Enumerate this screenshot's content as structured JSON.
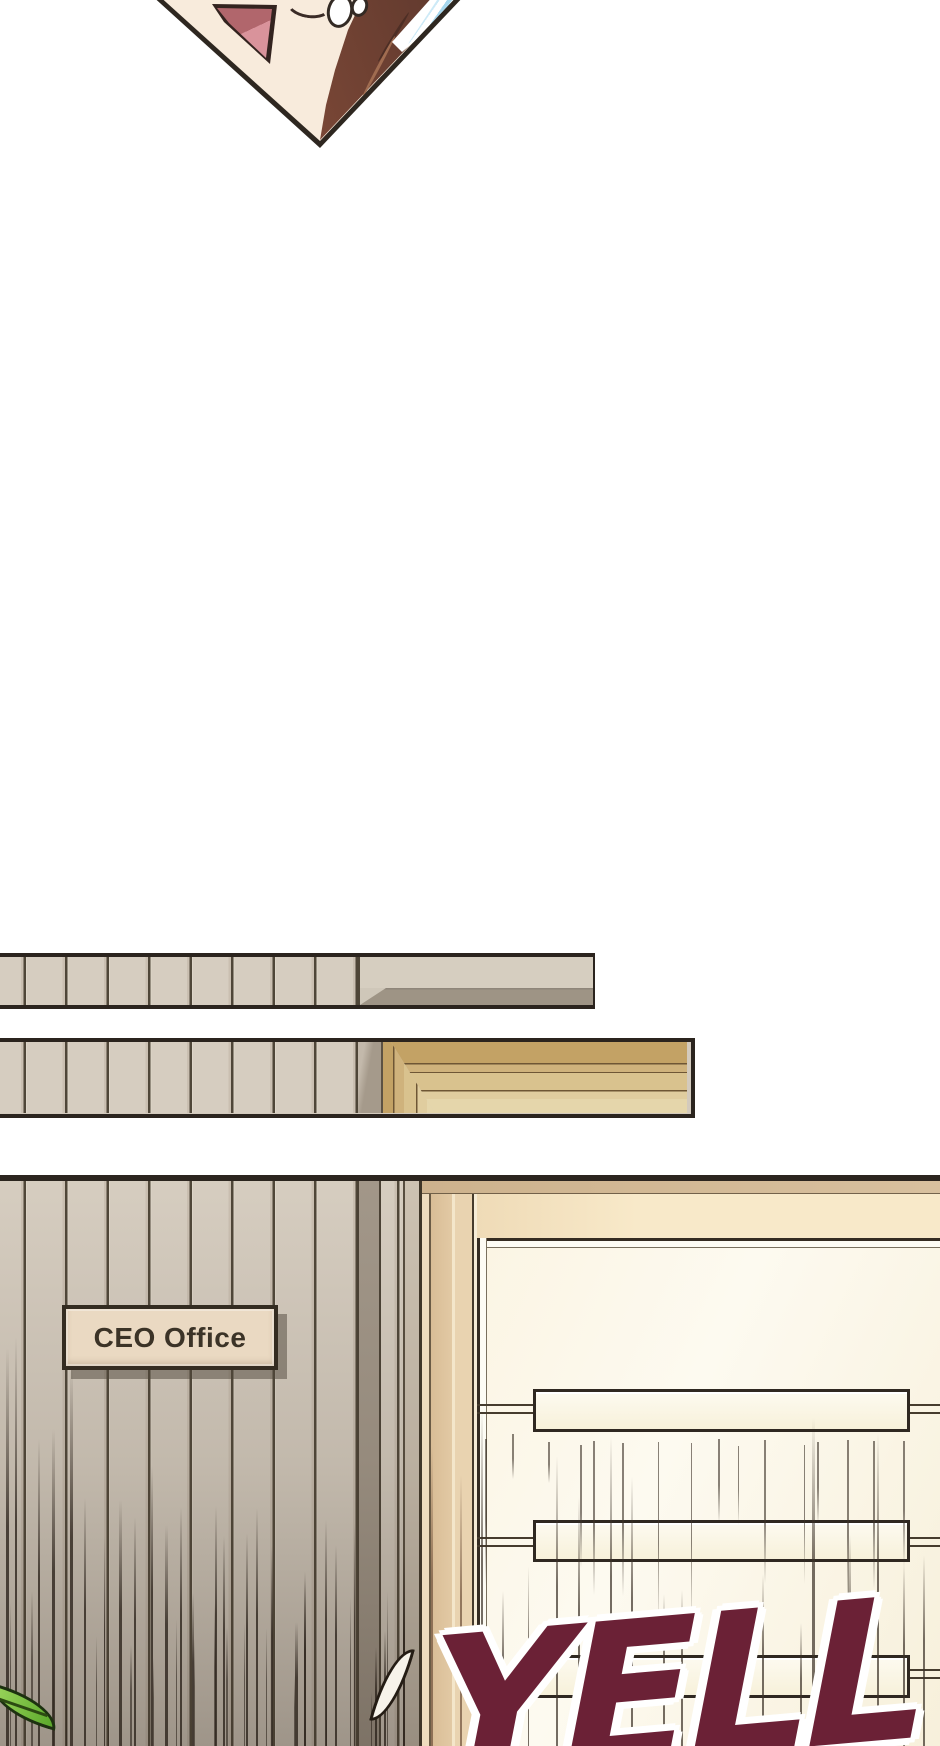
{
  "comic": {
    "sign": {
      "label": "CEO Office"
    },
    "sfx": {
      "text": "YELL"
    },
    "colors": {
      "background": "#ffffff",
      "panel_outline": "#2e2720",
      "wall_plank": "#d6cdc0",
      "door_wood": "#c9a96d",
      "sign_face": "#ead9c2",
      "sign_text": "#3b3327",
      "sfx_fill": "#6b2136",
      "sfx_outline": "#ffffff",
      "hair_brown": "#7a4736",
      "mouth_pink": "#d9939b",
      "stripe_blue": "#a6d7ee",
      "leaf_green": "#5aa82a"
    }
  }
}
